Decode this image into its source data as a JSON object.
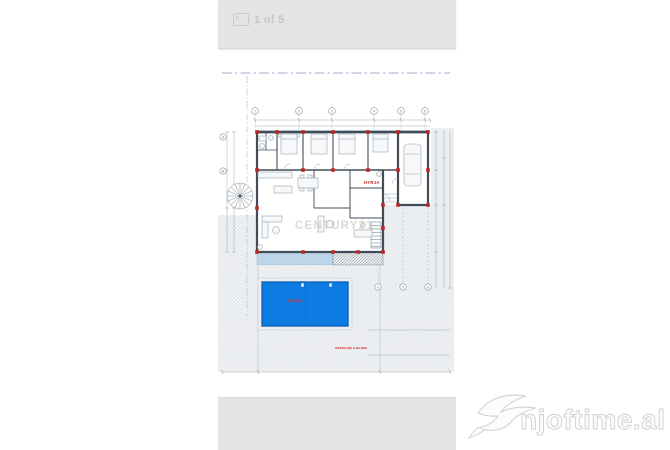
{
  "viewer": {
    "page_indicator": "1 of 5",
    "bar_color": "#e4e4e4"
  },
  "plan": {
    "entrance_label": "HYRJA",
    "pool_label": "PISHINA",
    "ground_note": "SIPERFAQE GJELBER",
    "watermark_agency": "CENTURY21",
    "grid_top": [
      "1",
      "2",
      "3",
      "4",
      "5",
      "6"
    ],
    "grid_left": [
      "A",
      "B"
    ],
    "grid_bottom": [
      "4",
      "5",
      "6"
    ],
    "colors": {
      "wall": "#424c57",
      "column_red": "#c22222",
      "boundary_dashed_blue": "#8393b8",
      "dimension_gray": "#99a3ad",
      "terrace_blue": "#bdd5e8",
      "pool_water_blue": "#0d7ce2",
      "pool_border_blue": "#0a5cb0",
      "hatch_gray": "#ccd0d6",
      "label_red": "#cc3333",
      "agency_watermark_tan": "#b7ae9e"
    }
  },
  "site_watermark": {
    "text": "njoftime.al"
  }
}
